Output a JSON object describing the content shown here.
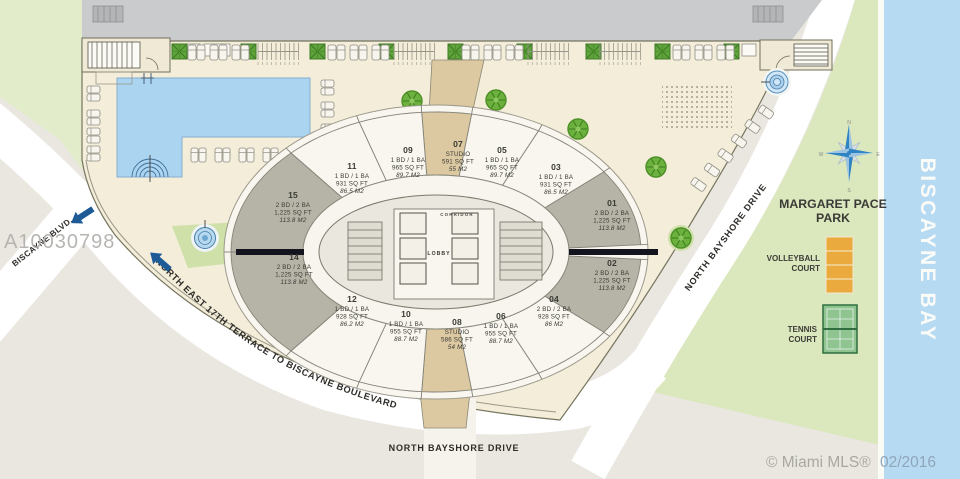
{
  "plan": {
    "mls_id": "A10030798",
    "credit_prefix": "© Miami MLS®",
    "credit_date": "02/2016"
  },
  "labels": {
    "biscayne_blvd": "BISCAYNE BLVD.",
    "terrace": "NORTH EAST  17TH TERRACE TO BISCAYNE BOULEVARD",
    "bayshore_right": "NORTH BAYSHORE DRIVE",
    "bayshore_bottom": "NORTH BAYSHORE DRIVE",
    "bay": "BISCAYNE BAY",
    "park_line1": "MARGARET PACE",
    "park_line2": "PARK",
    "volleyball_line1": "VOLLEYBALL",
    "volleyball_line2": "COURT",
    "tennis_line1": "TENNIS",
    "tennis_line2": "COURT",
    "corridor": "CORRIDOR",
    "lobby": "LOBBY"
  },
  "compass": {
    "north": "N",
    "south": "S",
    "east": "E",
    "west": "W"
  },
  "units": [
    {
      "num": "01",
      "beds": "2 BD / 2 BA",
      "sqft": "1,225 SQ FT",
      "m2": "113.8 M2",
      "category": "corner"
    },
    {
      "num": "02",
      "beds": "2 BD / 2 BA",
      "sqft": "1,225 SQ FT",
      "m2": "113.8 M2",
      "category": "corner"
    },
    {
      "num": "03",
      "beds": "1 BD / 1 BA",
      "sqft": "931 SQ FT",
      "m2": "86.5 M2",
      "category": "standard"
    },
    {
      "num": "04",
      "beds": "2 BD / 2 BA",
      "sqft": "928 SQ FT",
      "m2": "86 M2",
      "category": "standard"
    },
    {
      "num": "05",
      "beds": "1 BD / 1 BA",
      "sqft": "965 SQ FT",
      "m2": "89.7 M2",
      "category": "standard"
    },
    {
      "num": "06",
      "beds": "1 BD / 1 BA",
      "sqft": "955 SQ FT",
      "m2": "88.7 M2",
      "category": "standard"
    },
    {
      "num": "07",
      "beds": "STUDIO",
      "sqft": "591 SQ FT",
      "m2": "55 M2",
      "category": "studio"
    },
    {
      "num": "08",
      "beds": "STUDIO",
      "sqft": "586 SQ FT",
      "m2": "54 M2",
      "category": "studio"
    },
    {
      "num": "09",
      "beds": "1 BD / 1 BA",
      "sqft": "965 SQ FT",
      "m2": "89.7 M2",
      "category": "standard"
    },
    {
      "num": "10",
      "beds": "1 BD / 1 BA",
      "sqft": "955 SQ FT",
      "m2": "88.7 M2",
      "category": "standard"
    },
    {
      "num": "11",
      "beds": "1 BD / 1 BA",
      "sqft": "931 SQ FT",
      "m2": "86.5 M2",
      "category": "standard"
    },
    {
      "num": "12",
      "beds": "1 BD / 1 BA",
      "sqft": "928 SQ FT",
      "m2": "86.2 M2",
      "category": "standard"
    },
    {
      "num": "14",
      "beds": "2 BD / 2 BA",
      "sqft": "1,225 SQ FT",
      "m2": "113.8 M2",
      "category": "corner"
    },
    {
      "num": "15",
      "beds": "2 BD / 2 BA",
      "sqft": "1,225 SQ FT",
      "m2": "113.8 M2",
      "category": "corner"
    }
  ],
  "colors": {
    "background": "#e9e7e0",
    "deck": "#f3edda",
    "pool": "#abd4f0",
    "park": "#dbe7bd",
    "bay": "#b7daf3",
    "street": "#ffffff",
    "top_band": "#c9cbcc",
    "unit_standard": "#f8f6ef",
    "unit_corner": "#b6b4a6",
    "unit_studio": "#dcc9a2",
    "court_volleyball": "#eaaa3e",
    "court_tennis": "#8fc491",
    "arrow": "#1d5a96",
    "compass_blue": "#2f84c4",
    "text_dark": "#3a3a37",
    "watermark_gray": "#b4b2ae"
  }
}
